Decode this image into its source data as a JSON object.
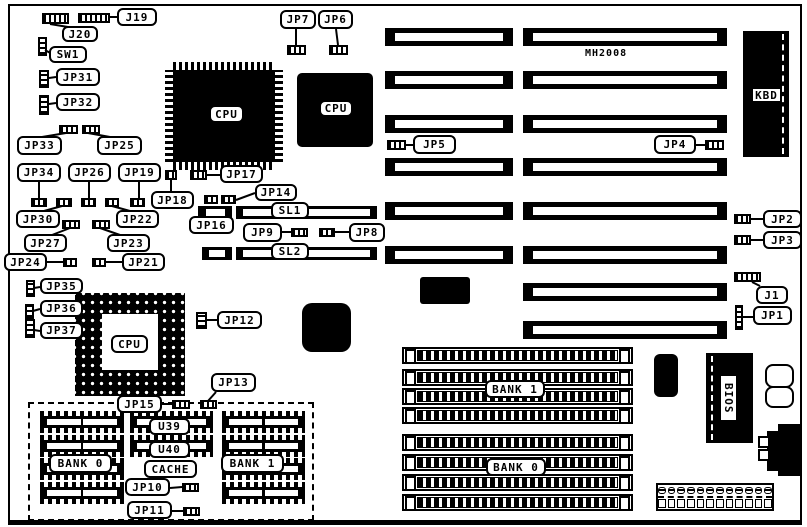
{
  "board": {
    "model": "MH2008"
  },
  "callouts": {
    "j19": "J19",
    "j20": "J20",
    "sw1": "SW1",
    "jp31": "JP31",
    "jp32": "JP32",
    "jp33": "JP33",
    "jp25": "JP25",
    "jp34": "JP34",
    "jp26": "JP26",
    "jp19": "JP19",
    "jp30": "JP30",
    "jp22": "JP22",
    "jp27": "JP27",
    "jp23": "JP23",
    "jp24": "JP24",
    "jp21": "JP21",
    "jp35": "JP35",
    "jp36": "JP36",
    "jp37": "JP37",
    "jp12": "JP12",
    "jp13": "JP13",
    "jp15": "JP15",
    "jp10": "JP10",
    "jp11": "JP11",
    "jp7": "JP7",
    "jp6": "JP6",
    "jp5": "JP5",
    "jp4": "JP4",
    "jp17": "JP17",
    "jp18": "JP18",
    "jp14": "JP14",
    "jp16": "JP16",
    "jp9": "JP9",
    "jp8": "JP8",
    "jp2": "JP2",
    "jp3": "JP3",
    "j1": "J1",
    "jp1": "JP1"
  },
  "chips": {
    "cpu_qfp": "CPU",
    "cpu_plcc": "CPU",
    "cpu_socket": "CPU",
    "kbd": "KBD",
    "bios": "BIOS"
  },
  "slots": {
    "sl1": "SL1",
    "sl2": "SL2"
  },
  "memory": {
    "dip_bank0": "BANK 0",
    "dip_bank1": "BANK 1",
    "u39": "U39",
    "u40": "U40",
    "cache": "CACHE",
    "simm_bank1": "BANK 1",
    "simm_bank0": "BANK 0"
  }
}
